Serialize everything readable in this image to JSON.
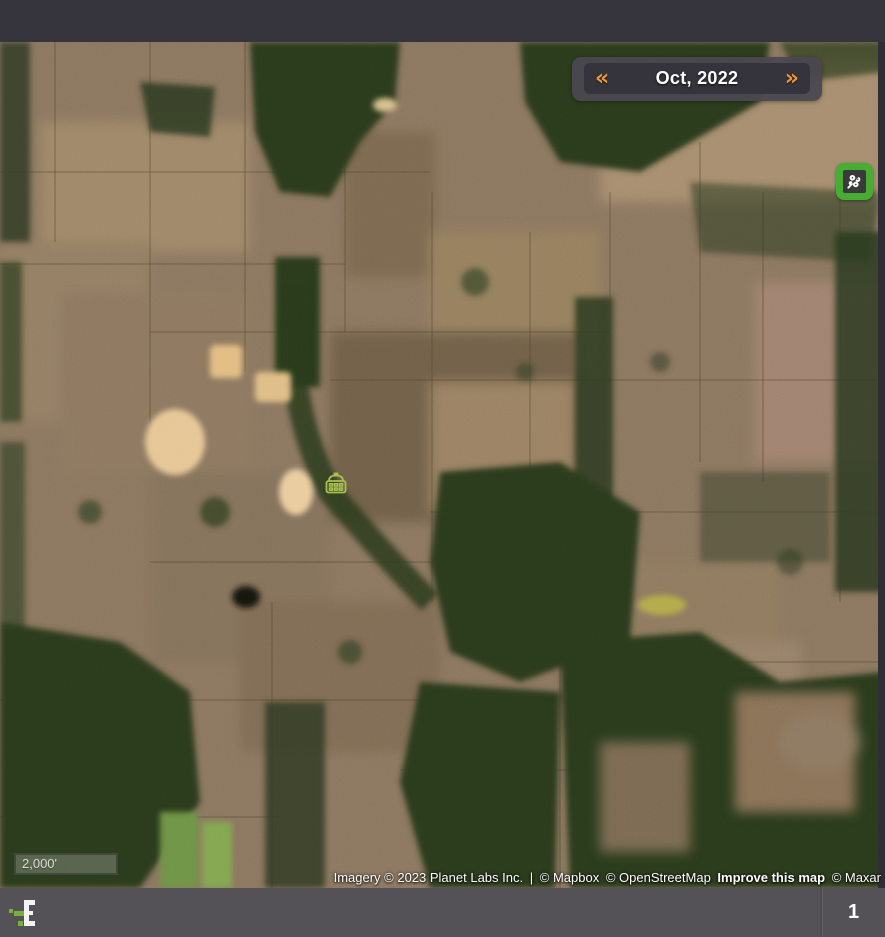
{
  "map": {
    "date_nav": {
      "prev_icon": "«",
      "label": "Oct, 2022",
      "next_icon": "»"
    },
    "tools": {
      "vegetation_button_icon": "flower-icon",
      "vegetation_button_color": "#4aad33"
    },
    "marker": {
      "icon": "farm-barn-icon",
      "color": "#a8c24f"
    },
    "scale_bar": {
      "label": "2,000'"
    },
    "attribution": {
      "imagery": "Imagery © 2023 Planet Labs Inc.",
      "divider": "|",
      "mapbox": "© Mapbox",
      "osm": "© OpenStreetMap",
      "improve": "Improve this map",
      "maxar": "© Maxar"
    }
  },
  "footer": {
    "page_number": "1"
  },
  "colors": {
    "accent_orange": "#ef9733",
    "button_green": "#4aad33",
    "marker_green": "#a8c24f",
    "top_bar": "#36343c",
    "footer_bar": "#545157"
  }
}
